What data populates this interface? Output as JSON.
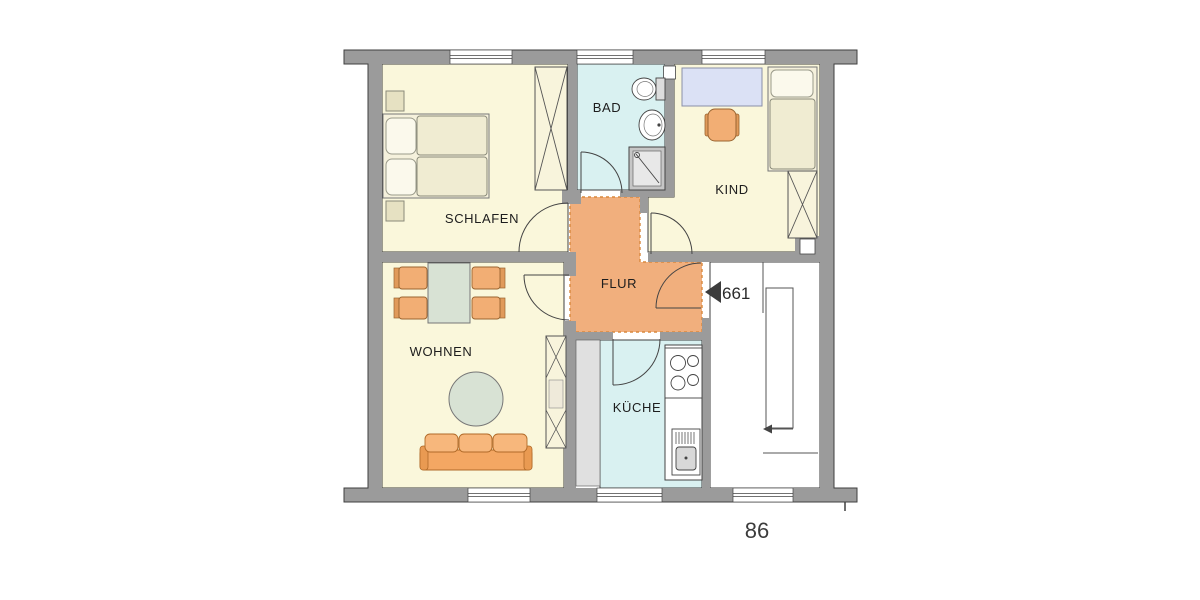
{
  "plan": {
    "room_labels": {
      "schlafen": "SCHLAFEN",
      "bad": "BAD",
      "kind": "KIND",
      "flur": "FLUR",
      "wohnen": "WOHNEN",
      "kueche": "KÜCHE"
    },
    "annotations": {
      "apartment_number": "661",
      "plan_number": "86"
    },
    "colors": {
      "wall_gray": "#9B9B9B",
      "room_cream": "#FAF7DB",
      "wet_room_cyan": "#D9F1F1",
      "flur_orange": "#F1AF7D",
      "flur_dash": "#D9893E",
      "furniture_orange": "#F2AE74",
      "table_green": "#D8E2D4",
      "desk_blue": "#DBE1F5"
    }
  }
}
